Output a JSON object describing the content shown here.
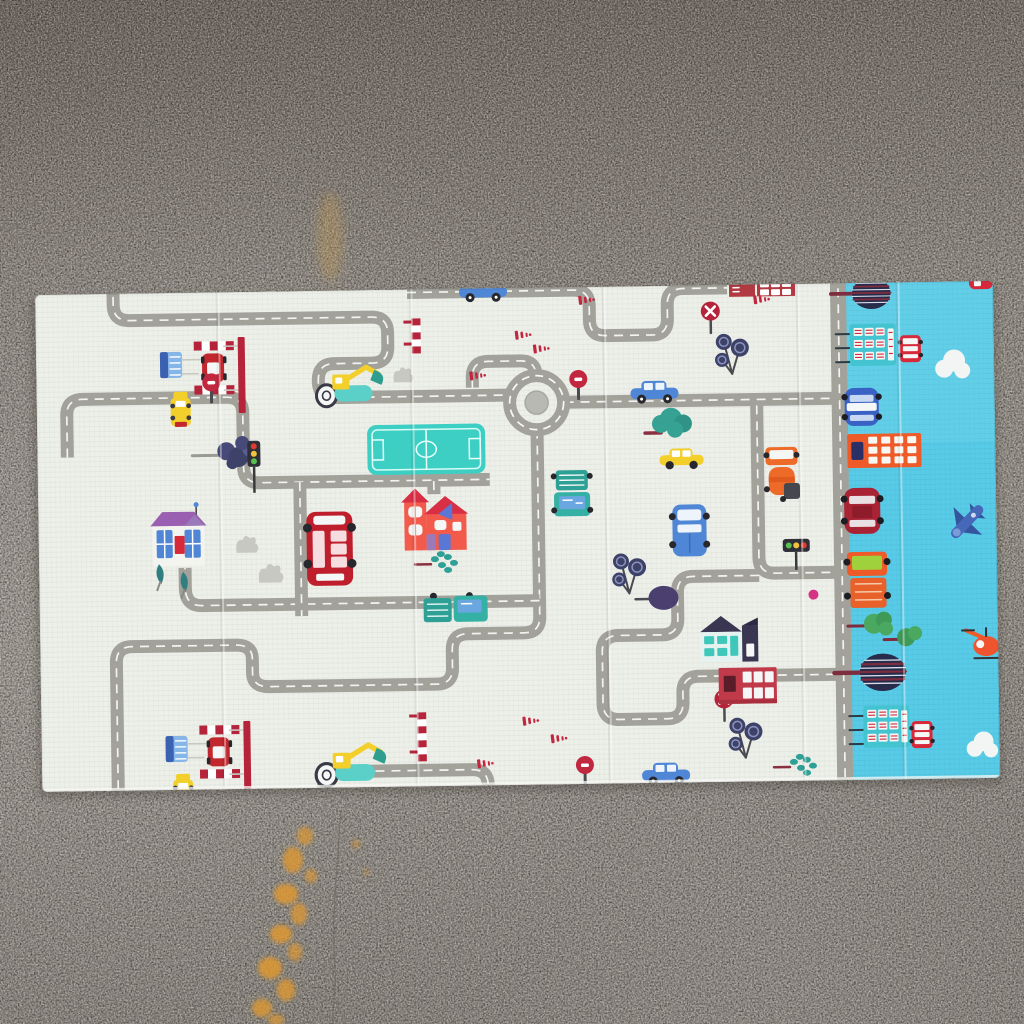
{
  "meta": {
    "alt": "Photograph of a foldable children's play mat with a road-traffic print lying on a speckled concrete floor with orange paint stains; the right strip of the mat shows the sky-blue city pattern of the reverse side"
  },
  "palette": {
    "floor_top": "#7e766d",
    "floor_upper": "#8b847b",
    "floor_mid": "#99938a",
    "floor_light": "#a09a90",
    "floor_bottom": "#8e8880",
    "stain_orange": "#de9832",
    "stain_soft": "#c49a52",
    "crack": "#675f57",
    "mat": "#edefe9",
    "mat_edge_light": "#f7f7f3",
    "blue": "#57cbe7",
    "blue_light": "#79d8ef",
    "road": "#a2a29b",
    "road_dark": "#979790",
    "dash": "#f8f8f4",
    "island": "#b9b9b3",
    "field": "#3ecfc4",
    "field_line": "#e8fffb",
    "red": "#c1272d",
    "bus_red": "#bf1f2c",
    "crimson": "#b5243a",
    "dark_red": "#a82334",
    "brick_red": "#c13a4a",
    "house_red": "#f25a4b",
    "roof_red": "#d92f45",
    "orange": "#ee6a28",
    "sky_orange": "#ee5a28",
    "yellow": "#f2cf2a",
    "teal": "#3ec7ba",
    "teal_dark": "#2fa095",
    "teal_house": "#e6f2f0",
    "green": "#4aa860",
    "green2": "#3f9a58",
    "light_green": "#9ed13c",
    "car_blue": "#4f86d6",
    "pale_blue": "#86b5e8",
    "police_blue": "#3a62c4",
    "plane_blue": "#4668b8",
    "plane_dark": "#35559e",
    "navy": "#3a3f63",
    "navy_tree": "#262c4a",
    "plum": "#4a3f6e",
    "purple": "#9a5fb0",
    "purple2": "#9a7ab8",
    "trunk": "#7e2d3e",
    "maroon": "#8a3040",
    "gray_bush": "#c8c8c2",
    "dark": "#27272d",
    "pole": "#4a4a50",
    "white": "#f4f7f5",
    "station_teal": "#43c4d0",
    "pink": "#d63384",
    "window_white": "#eef4fb",
    "cloud": "#f2f5f3"
  },
  "floor": {
    "stains": [
      {
        "x": 330,
        "y": 237,
        "rx": 13,
        "ry": 45,
        "o": 0.35,
        "soft": true
      },
      {
        "x": 305,
        "y": 836,
        "rx": 8,
        "ry": 9,
        "o": 0.7
      },
      {
        "x": 293,
        "y": 860,
        "rx": 10,
        "ry": 13,
        "o": 0.8
      },
      {
        "x": 311,
        "y": 876,
        "rx": 6,
        "ry": 7,
        "o": 0.65
      },
      {
        "x": 286,
        "y": 894,
        "rx": 12,
        "ry": 10,
        "o": 0.85
      },
      {
        "x": 299,
        "y": 914,
        "rx": 8,
        "ry": 11,
        "o": 0.75
      },
      {
        "x": 281,
        "y": 934,
        "rx": 11,
        "ry": 9,
        "o": 0.85
      },
      {
        "x": 295,
        "y": 952,
        "rx": 7,
        "ry": 9,
        "o": 0.7
      },
      {
        "x": 270,
        "y": 968,
        "rx": 12,
        "ry": 11,
        "o": 0.85
      },
      {
        "x": 286,
        "y": 990,
        "rx": 9,
        "ry": 11,
        "o": 0.8
      },
      {
        "x": 262,
        "y": 1008,
        "rx": 10,
        "ry": 9,
        "o": 0.8
      },
      {
        "x": 276,
        "y": 1020,
        "rx": 8,
        "ry": 6,
        "o": 0.7
      },
      {
        "x": 356,
        "y": 844,
        "rx": 4,
        "ry": 4,
        "o": 0.55
      },
      {
        "x": 366,
        "y": 872,
        "rx": 3,
        "ry": 3,
        "o": 0.45
      }
    ],
    "crack": "M 341,810 C 338,858 331,918 335,968 C 337,996 331,1012 333,1026"
  },
  "mat": {
    "x": 35,
    "y": 295,
    "w": 958,
    "h": 497,
    "rotate": -0.84,
    "blue_panel_x": 810,
    "creases": [
      182,
      375,
      568,
      762,
      862
    ],
    "roads": [
      {
        "d": "M 78,-8 V 16 Q 78,32 94,32 H 336 Q 352,32 352,48 V 62 Q 352,78 336,78 H 298 Q 282,78 282,95 Q 282,112 298,112 H 470",
        "w": 13
      },
      {
        "d": "M 528,120 H 800",
        "w": 13
      },
      {
        "d": "M 720,126 V 278 Q 720,294 736,294 H 800",
        "w": 13
      },
      {
        "d": "M 720,296 H 654 Q 638,296 638,312 V 338 Q 638,354 622,354 H 578 Q 562,354 562,370 V 422 Q 562,438 578,438 H 626 Q 642,438 642,422 V 412 Q 642,396 658,396 H 800",
        "w": 13
      },
      {
        "d": "M 500,147 V 334 Q 500,350 484,350 H 428 Q 412,350 412,366 V 384 Q 412,400 396,400 H 228 Q 212,400 212,386 V 372 Q 212,358 196,358 H 92 Q 76,358 76,374 V 505",
        "w": 13
      },
      {
        "d": "M 30,168 V 126 Q 30,110 46,110 H 190 Q 206,110 206,126 V 180 Q 206,196 222,196 H 452",
        "w": 13
      },
      {
        "d": "M 500,318 H 162 Q 146,318 146,300 V 280",
        "w": 13
      },
      {
        "d": "M 372,8 H 538 Q 554,8 554,24 V 38 Q 554,54 570,54 H 616 Q 632,54 632,38 V 24 Q 632,8 648,8 H 692",
        "w": 13
      },
      {
        "d": "M 436,104 V 94 Q 436,78 452,78 H 484 Q 500,78 500,94",
        "w": 13
      },
      {
        "d": "M 281,504 Q 281,486 297,486 H 430 Q 446,486 446,502",
        "w": 13
      },
      {
        "d": "M 262,196 V 330",
        "w": 13
      },
      {
        "d": "M 396,197 V 210",
        "w": 13
      },
      {
        "d": "M 803,-6 V 504",
        "w": 16
      }
    ],
    "items": [
      {
        "t": "field",
        "x": 330,
        "y": 140
      },
      {
        "t": "roundabout",
        "x": 500,
        "y": 120
      },
      {
        "t": "toll",
        "x": 124,
        "y": 50
      },
      {
        "t": "toll",
        "x": 124,
        "y": 434
      },
      {
        "t": "ytruck",
        "x": 134,
        "y": 104
      },
      {
        "t": "ytruck",
        "x": 131,
        "y": 486
      },
      {
        "t": "excavator",
        "x": 278,
        "y": 84
      },
      {
        "t": "excavator",
        "x": 272,
        "y": 462,
        "s": 1.05
      },
      {
        "t": "shrub",
        "x": 155,
        "y": 152
      },
      {
        "t": "tlight",
        "x": 210,
        "y": 154,
        "o": "v"
      },
      {
        "t": "tlight",
        "x": 744,
        "y": 260,
        "o": "h"
      },
      {
        "t": "phouse",
        "x": 114,
        "y": 222
      },
      {
        "t": "tpair",
        "x": 112,
        "y": 276
      },
      {
        "t": "gbush",
        "x": 196,
        "y": 246,
        "s": 0.9
      },
      {
        "t": "gbush",
        "x": 218,
        "y": 274
      },
      {
        "t": "gbush",
        "x": 356,
        "y": 80,
        "s": 0.8
      },
      {
        "t": "dbus",
        "x": 268,
        "y": 226
      },
      {
        "t": "rhouse",
        "x": 366,
        "y": 206
      },
      {
        "t": "sprigs",
        "x": 376,
        "y": 268
      },
      {
        "t": "sprigs",
        "x": 732,
        "y": 476
      },
      {
        "t": "stopsign",
        "x": 166,
        "y": 86
      },
      {
        "t": "stopsign",
        "x": 533,
        "y": 88
      },
      {
        "t": "stopsign",
        "x": 534,
        "y": 474
      },
      {
        "t": "noentry",
        "x": 666,
        "y": 22
      },
      {
        "t": "noentry",
        "x": 674,
        "y": 410
      },
      {
        "t": "cblue",
        "x": 424,
        "y": -4
      },
      {
        "t": "cblue",
        "x": 594,
        "y": 100
      },
      {
        "t": "cblue",
        "x": 600,
        "y": 482
      },
      {
        "t": "tleafy",
        "x": 608,
        "y": 128
      },
      {
        "t": "cyellow",
        "x": 622,
        "y": 168
      },
      {
        "t": "pickupv",
        "x": 516,
        "y": 188
      },
      {
        "t": "pickuph",
        "x": 384,
        "y": 310
      },
      {
        "t": "fuel",
        "x": 728,
        "y": 168
      },
      {
        "t": "van",
        "x": 634,
        "y": 224
      },
      {
        "t": "lolli",
        "x": 678,
        "y": 54
      },
      {
        "t": "lolli",
        "x": 572,
        "y": 272
      },
      {
        "t": "lolli",
        "x": 686,
        "y": 438
      },
      {
        "t": "ptree",
        "x": 606,
        "y": 304
      },
      {
        "t": "pdot",
        "x": 774,
        "y": 316
      },
      {
        "t": "bredtop",
        "x": 694,
        "y": 0
      },
      {
        "t": "thouse",
        "x": 660,
        "y": 336
      },
      {
        "t": "bred2",
        "x": 678,
        "y": 388
      },
      {
        "t": "ladder",
        "x": 376,
        "y": 34,
        "h": 30
      },
      {
        "t": "ladder",
        "x": 376,
        "y": 428,
        "h": 44
      },
      {
        "t": "rmarks",
        "x": 543,
        "y": 14
      },
      {
        "t": "rmarks",
        "x": 718,
        "y": 16
      },
      {
        "t": "rmarks",
        "x": 479,
        "y": 48
      },
      {
        "t": "rmarks",
        "x": 497,
        "y": 62
      },
      {
        "t": "rmarks",
        "x": 433,
        "y": 88
      },
      {
        "t": "rmarks",
        "x": 481,
        "y": 434
      },
      {
        "t": "rmarks",
        "x": 435,
        "y": 476
      },
      {
        "t": "rmarks",
        "x": 509,
        "y": 452
      },
      {
        "t": "bstree",
        "x": 816,
        "y": 0,
        "s": 0.92
      },
      {
        "t": "bstree",
        "x": 818,
        "y": 376,
        "s": 1.1
      },
      {
        "t": "bstation",
        "x": 814,
        "y": 46
      },
      {
        "t": "bminibus",
        "x": 864,
        "y": 58
      },
      {
        "t": "bstation",
        "x": 822,
        "y": 428
      },
      {
        "t": "bminibus",
        "x": 870,
        "y": 444
      },
      {
        "t": "bcloud",
        "x": 898,
        "y": 76
      },
      {
        "t": "bcloud",
        "x": 924,
        "y": 458,
        "s": 0.9
      },
      {
        "t": "bpolice",
        "x": 808,
        "y": 110
      },
      {
        "t": "borange",
        "x": 810,
        "y": 156
      },
      {
        "t": "bcred",
        "x": 806,
        "y": 210
      },
      {
        "t": "bplane",
        "x": 928,
        "y": 246
      },
      {
        "t": "btruck",
        "x": 808,
        "y": 274
      },
      {
        "t": "bgtrees",
        "x": 822,
        "y": 336
      },
      {
        "t": "bheli",
        "x": 930,
        "y": 352
      },
      {
        "t": "bcorner",
        "x": 934,
        "y": 0
      }
    ]
  }
}
